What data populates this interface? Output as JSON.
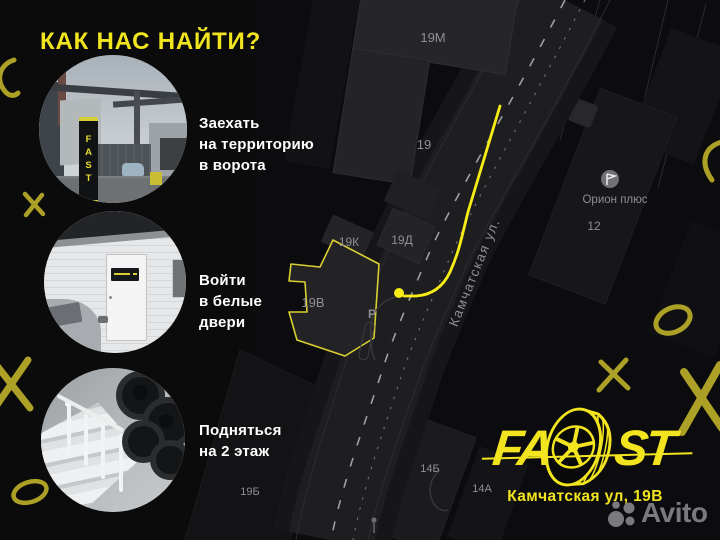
{
  "title": "КАК НАС НАЙТИ?",
  "steps": [
    {
      "text": "Заехать\nна территорию\nв ворота",
      "photo_sign": "FAST"
    },
    {
      "text": "Войти\nв белые\nдвери"
    },
    {
      "text": "Подняться\nна 2 этаж"
    }
  ],
  "map": {
    "street": "Камчатская ул.",
    "parking": "Р",
    "poi": {
      "name": "Орион плюс",
      "number": "12"
    },
    "labels": {
      "b19m": "19М",
      "b19": "19",
      "b19k": "19К",
      "b19d": "19Д",
      "b19v": "19В",
      "b14b": "14Б",
      "b14a": "14А",
      "b19b": "19Б"
    }
  },
  "brand": {
    "logo_left": "FA",
    "logo_right": "ST",
    "address": "Камчатская ул, 19В"
  },
  "watermark": "Avito",
  "colors": {
    "accent_yellow": "#F2E41E",
    "route_yellow": "#F6EC16",
    "doodle_yellow": "#C0B12A",
    "background": "#0B0B0C",
    "building_gray": "#242427",
    "label_gray": "#8F8F93"
  }
}
